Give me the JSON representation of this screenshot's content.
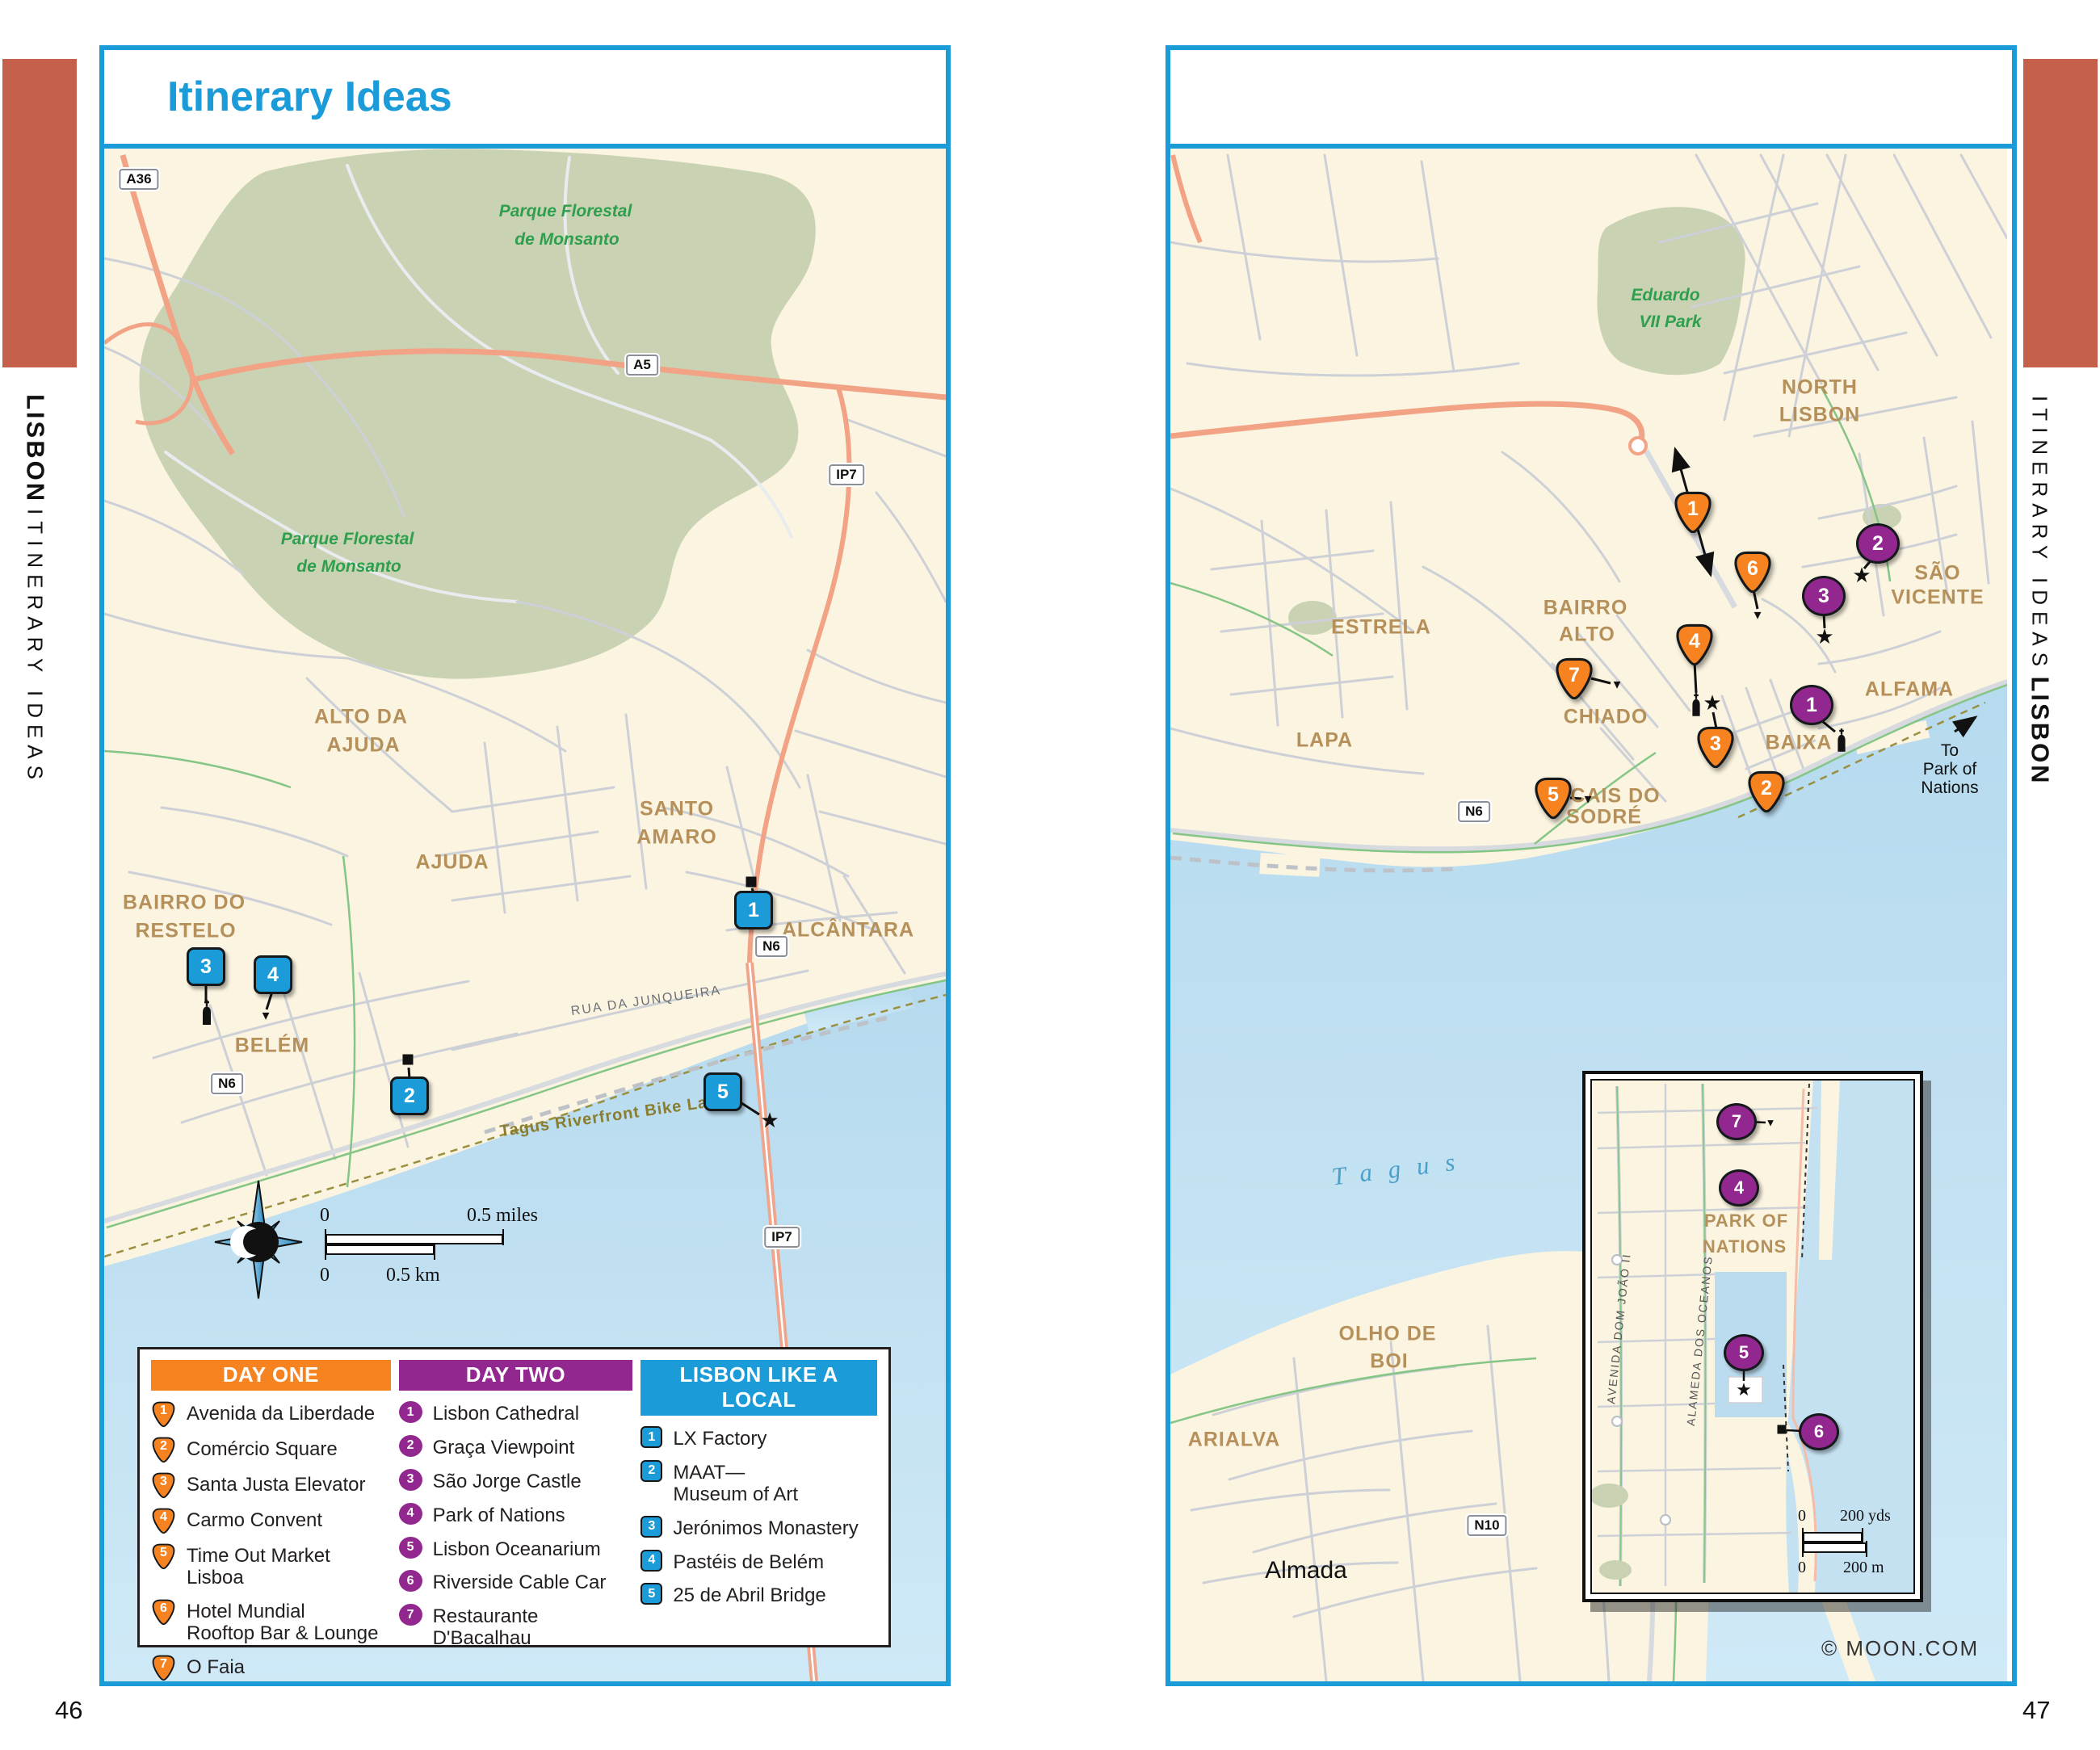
{
  "page": {
    "title": "Itinerary Ideas",
    "left_page_number": "46",
    "right_page_number": "47",
    "edge_title": "LISBON",
    "edge_subtitle": "ITINERARY IDEAS",
    "credit": "© MOON.COM"
  },
  "colors": {
    "accent_blue": "#1B9BD8",
    "marker_orange": "#F68220",
    "marker_purple": "#92278F",
    "terracotta": "#C5614A",
    "land": "#FBF4E0",
    "water": "#BFE0F0",
    "park_green": "#C9D3B4",
    "label_brown": "#B5905A",
    "label_green": "#2F9E4D"
  },
  "left_map": {
    "region_labels": {
      "monsanto1a": "Parque Florestal",
      "monsanto1b": "de Monsanto",
      "monsanto2a": "Parque Florestal",
      "monsanto2b": "de Monsanto",
      "alto_da": "ALTO DA",
      "ajuda1": "AJUDA",
      "santo": "SANTO",
      "amaro": "AMARO",
      "bairro_do": "BAIRRO DO",
      "restelo": "RESTELO",
      "ajuda2": "AJUDA",
      "belem": "BELÉM",
      "alcantara": "ALCÂNTARA"
    },
    "street_labels": {
      "rua": "RUA DA JUNQUEIRA",
      "bike": "Tagus Riverfront Bike Lane"
    },
    "shields": {
      "a36": "A36",
      "a5": "A5",
      "ip7a": "IP7",
      "n6a": "N6",
      "n6b": "N6",
      "ip7b": "IP7"
    },
    "scale": {
      "zero": "0",
      "miles": "0.5 miles",
      "km": "0.5 km"
    },
    "markers": [
      "1",
      "2",
      "3",
      "4",
      "5"
    ]
  },
  "right_map": {
    "region_labels": {
      "eduardo1": "Eduardo",
      "eduardo2": "VII Park",
      "north": "NORTH",
      "lisbon": "LISBON",
      "estrela": "ESTRELA",
      "lapa": "LAPA",
      "bairro": "BAIRRO",
      "alto": "ALTO",
      "chiado": "CHIADO",
      "cais_do": "CAIS DO",
      "sodre": "SODRÉ",
      "baixa": "BAIXA",
      "alfama": "ALFAMA",
      "sao": "SÃO",
      "vicente": "VICENTE",
      "olho1": "OLHO DE",
      "olho2": "BOI",
      "arialva": "ARIALVA",
      "almada": "Almada",
      "tagus": "Tagus"
    },
    "to_park": {
      "l1": "To",
      "l2": "Park of",
      "l3": "Nations"
    },
    "shields": {
      "n6": "N6",
      "n10": "N10"
    },
    "orange_markers": [
      "1",
      "2",
      "3",
      "4",
      "5",
      "6",
      "7"
    ],
    "purple_markers": [
      "1",
      "2",
      "3"
    ]
  },
  "inset": {
    "labels": {
      "park_of": "PARK OF",
      "nations": "NATIONS",
      "alameda": "ALAMEDA DOS OCEANOS",
      "avenida": "AVENIDA DOM JOÃO II"
    },
    "scale": {
      "zero1": "0",
      "yds": "200 yds",
      "zero2": "0",
      "m": "200 m"
    },
    "purple_markers": [
      "4",
      "5",
      "6",
      "7"
    ]
  },
  "legend": {
    "columns": [
      {
        "title": "DAY ONE",
        "items": [
          {
            "n": "1",
            "label": "Avenida da Liberdade"
          },
          {
            "n": "2",
            "label": "Comércio Square"
          },
          {
            "n": "3",
            "label": "Santa Justa Elevator"
          },
          {
            "n": "4",
            "label": "Carmo Convent"
          },
          {
            "n": "5",
            "label": "Time Out Market Lisboa"
          },
          {
            "n": "6",
            "label": "Hotel Mundial\nRooftop Bar & Lounge"
          },
          {
            "n": "7",
            "label": "O Faia"
          }
        ]
      },
      {
        "title": "DAY TWO",
        "items": [
          {
            "n": "1",
            "label": "Lisbon Cathedral"
          },
          {
            "n": "2",
            "label": "Graça Viewpoint"
          },
          {
            "n": "3",
            "label": "São Jorge Castle"
          },
          {
            "n": "4",
            "label": "Park of Nations"
          },
          {
            "n": "5",
            "label": "Lisbon Oceanarium"
          },
          {
            "n": "6",
            "label": "Riverside Cable Car"
          },
          {
            "n": "7",
            "label": "Restaurante\nD'Bacalhau"
          }
        ]
      },
      {
        "title": "LISBON LIKE A LOCAL",
        "items": [
          {
            "n": "1",
            "label": "LX Factory"
          },
          {
            "n": "2",
            "label": "MAAT—\nMuseum of Art"
          },
          {
            "n": "3",
            "label": "Jerónimos Monastery"
          },
          {
            "n": "4",
            "label": "Pastéis de Belém"
          },
          {
            "n": "5",
            "label": "25 de Abril Bridge"
          }
        ]
      }
    ]
  }
}
